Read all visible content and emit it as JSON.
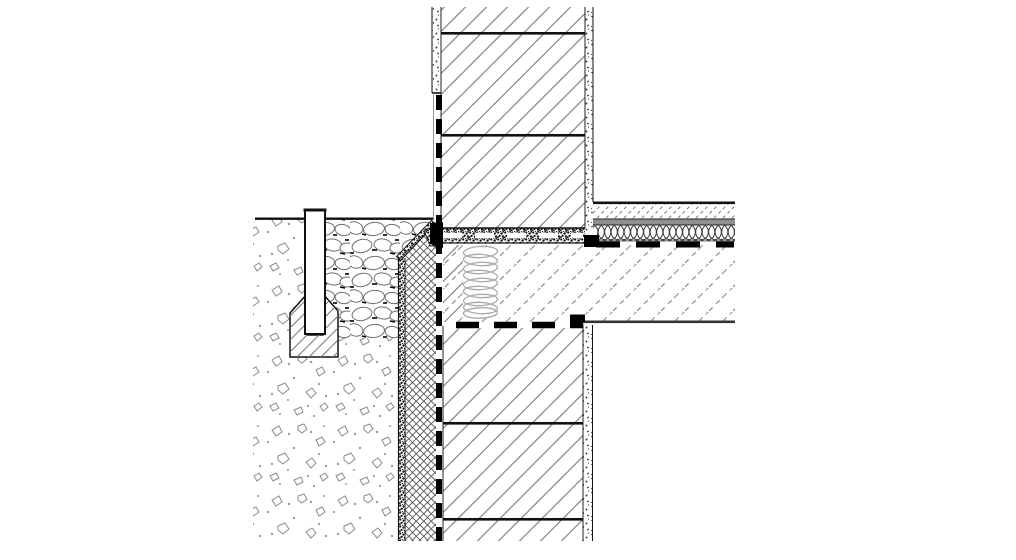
{
  "drawing": {
    "kind": "construction-detail-section",
    "subject": "basement wall plinth junction with ceiling slab, perimeter insulation, waterproofing and drainage",
    "visible_text": [],
    "colors": {
      "paper": "#ffffff",
      "ink": "#111111",
      "hatch_dark": "#8c8c8c",
      "hatch_light": "#b8b8b8",
      "concrete_hatch": "#9a9a9a",
      "separation_band": "#8f8f8f",
      "slab_edge_line": "#333333"
    },
    "parts": [
      {
        "name": "soil-ground",
        "pattern": "scattered-stones"
      },
      {
        "name": "gravel-drainage-fill",
        "pattern": "cobbles"
      },
      {
        "name": "drain-concrete-block",
        "pattern": "diagonal-hatch"
      },
      {
        "name": "inspection-pipe",
        "pattern": "none"
      },
      {
        "name": "ground-line",
        "pattern": "solid-line"
      },
      {
        "name": "perimeter-insulation-board",
        "pattern": "crosshatch"
      },
      {
        "name": "protection-layer-strip",
        "pattern": "dense-speckle"
      },
      {
        "name": "insulation-slope-cap",
        "pattern": "dense-speckle"
      },
      {
        "name": "vertical-waterproofing-membrane",
        "pattern": "heavy-dashed-line"
      },
      {
        "name": "exterior-plaster",
        "pattern": "speckle"
      },
      {
        "name": "masonry-wall-upper",
        "pattern": "diagonal-hatch-with-joints"
      },
      {
        "name": "masonry-wall-lower",
        "pattern": "diagonal-hatch-with-joints"
      },
      {
        "name": "bed-joint-seal-band",
        "pattern": "speckle-with-white-dashes"
      },
      {
        "name": "concrete-ceiling-slab",
        "pattern": "broken-diagonal-hatch"
      },
      {
        "name": "slab-edge-insulation-coil",
        "pattern": "coil-loops"
      },
      {
        "name": "floor-screed",
        "pattern": "fine-diagonal-dashes"
      },
      {
        "name": "separation-layer",
        "pattern": "solid-gray-band"
      },
      {
        "name": "impact-sound-insulation",
        "pattern": "diamond-chain"
      },
      {
        "name": "floor-waterproofing-membrane",
        "pattern": "heavy-dashed-line"
      },
      {
        "name": "lower-bed-joint-membrane",
        "pattern": "heavy-dashed-line"
      },
      {
        "name": "interior-plaster-upper",
        "pattern": "speckle"
      },
      {
        "name": "interior-plaster-lower",
        "pattern": "speckle"
      }
    ]
  }
}
